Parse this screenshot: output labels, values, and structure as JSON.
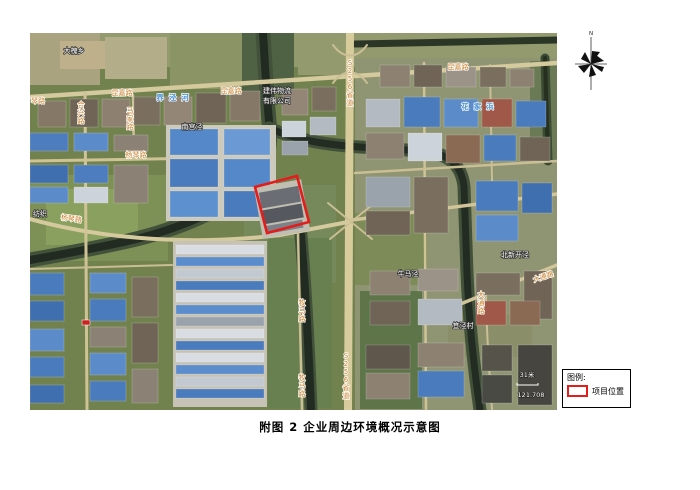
{
  "figure": {
    "caption": "附图 2  企业周边环境概况示意图"
  },
  "compass": {
    "north_label": "N"
  },
  "legend": {
    "title": "图例:",
    "items": [
      {
        "symbol": "red-rectangle-outline",
        "symbol_color": "#e41c1c",
        "label": "项目位置"
      }
    ]
  },
  "map": {
    "type": "satellite-imagery",
    "project_marker_color": "#e41c1c",
    "labels": [
      {
        "text": "大槐乡",
        "x": 44,
        "y": 20,
        "type": "place"
      },
      {
        "text": "昆嘉路",
        "x": 92,
        "y": 62,
        "type": "road"
      },
      {
        "text": "昆嘉路",
        "x": 201,
        "y": 60,
        "type": "road"
      },
      {
        "text": "昆嘉路",
        "x": 428,
        "y": 36,
        "type": "road"
      },
      {
        "text": "S256省道",
        "x": 320,
        "y": 32,
        "type": "road",
        "vertical": true
      },
      {
        "text": "S256省道",
        "x": 316,
        "y": 325,
        "type": "road",
        "vertical": true
      },
      {
        "text": "建伟物流",
        "x": 247,
        "y": 60,
        "type": "place"
      },
      {
        "text": "有限公司",
        "x": 247,
        "y": 70,
        "type": "place"
      },
      {
        "text": "南宫泾",
        "x": 162,
        "y": 96,
        "type": "place"
      },
      {
        "text": "杨琴路",
        "x": 106,
        "y": 124,
        "type": "road"
      },
      {
        "text": "杨琴路",
        "x": 41,
        "y": 188,
        "type": "road",
        "rotate": 8
      },
      {
        "text": "合兴路",
        "x": 51,
        "y": 74,
        "type": "road",
        "vertical": true
      },
      {
        "text": "马家路",
        "x": 100,
        "y": 80,
        "type": "road",
        "vertical": true
      },
      {
        "text": "琴路",
        "x": 8,
        "y": 70,
        "type": "road"
      },
      {
        "text": "牧马路",
        "x": 272,
        "y": 272,
        "type": "road",
        "vertical": true
      },
      {
        "text": "牧马路",
        "x": 272,
        "y": 347,
        "type": "road",
        "vertical": true
      },
      {
        "text": "牛马泾",
        "x": 378,
        "y": 243,
        "type": "place"
      },
      {
        "text": "北新开泾",
        "x": 485,
        "y": 224,
        "type": "place"
      },
      {
        "text": "笪泾村",
        "x": 433,
        "y": 295,
        "type": "place"
      },
      {
        "text": "大通路",
        "x": 514,
        "y": 246,
        "type": "road",
        "rotate": -18
      },
      {
        "text": "大通路",
        "x": 451,
        "y": 264,
        "type": "road",
        "vertical": true
      },
      {
        "text": "界泾河",
        "x": 145,
        "y": 67,
        "type": "water",
        "spacing": 5
      },
      {
        "text": "花家浜",
        "x": 450,
        "y": 76,
        "type": "water",
        "spacing": 5
      },
      {
        "text": "纺织",
        "x": 10,
        "y": 183,
        "type": "place"
      },
      {
        "text": "31米",
        "x": 497,
        "y": 344,
        "type": "scale"
      },
      {
        "text": "121.708",
        "x": 501,
        "y": 364,
        "type": "scale"
      }
    ]
  }
}
